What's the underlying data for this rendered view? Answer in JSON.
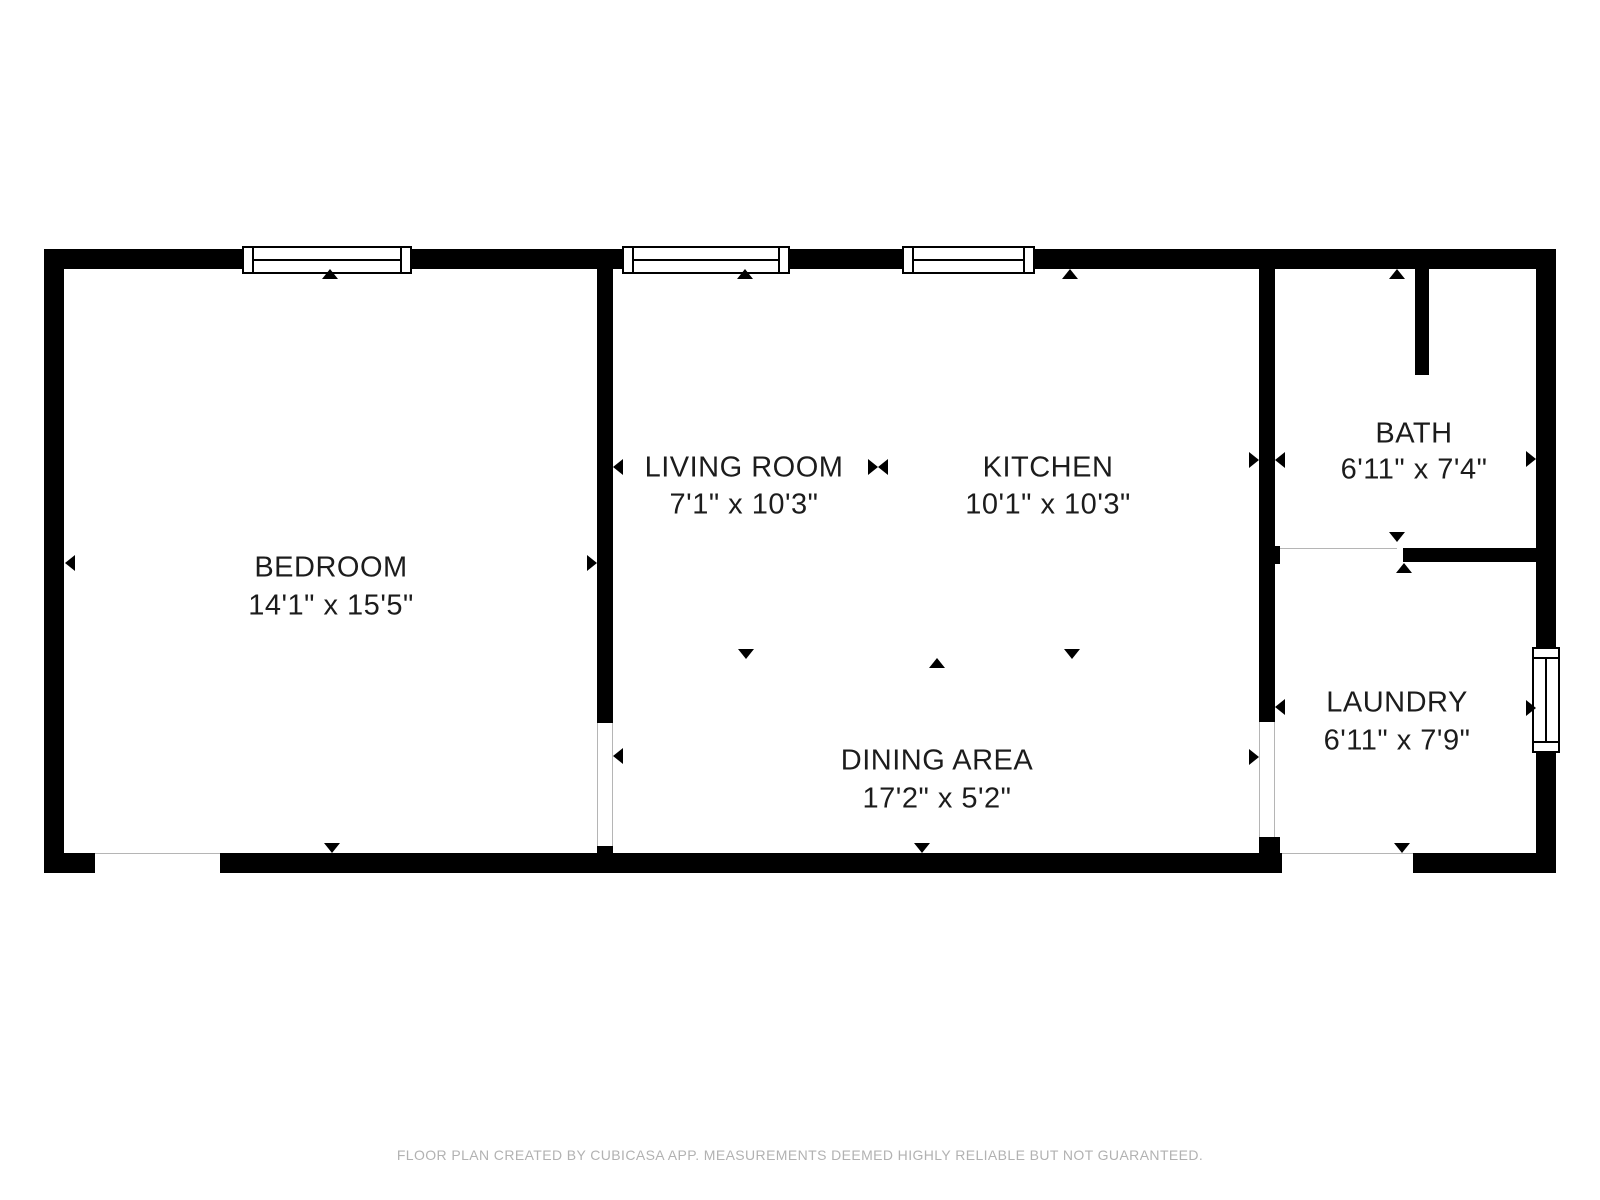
{
  "rooms": [
    {
      "name": "BEDROOM",
      "dimensions": "14'1\" x 15'5\""
    },
    {
      "name": "LIVING ROOM",
      "dimensions": "7'1\" x 10'3\""
    },
    {
      "name": "KITCHEN",
      "dimensions": "10'1\" x 10'3\""
    },
    {
      "name": "DINING AREA",
      "dimensions": "17'2\" x 5'2\""
    },
    {
      "name": "BATH",
      "dimensions": "6'11\" x 7'4\""
    },
    {
      "name": "LAUNDRY",
      "dimensions": "6'11\" x 7'9\""
    }
  ],
  "footer": {
    "disclaimer": "FLOOR PLAN CREATED BY CUBICASA APP. MEASUREMENTS DEEMED HIGHLY RELIABLE BUT NOT GUARANTEED."
  },
  "colors": {
    "wall": "#000000",
    "label": "#1c1c1c",
    "footer_text": "#b2b2b2",
    "background": "#ffffff"
  }
}
